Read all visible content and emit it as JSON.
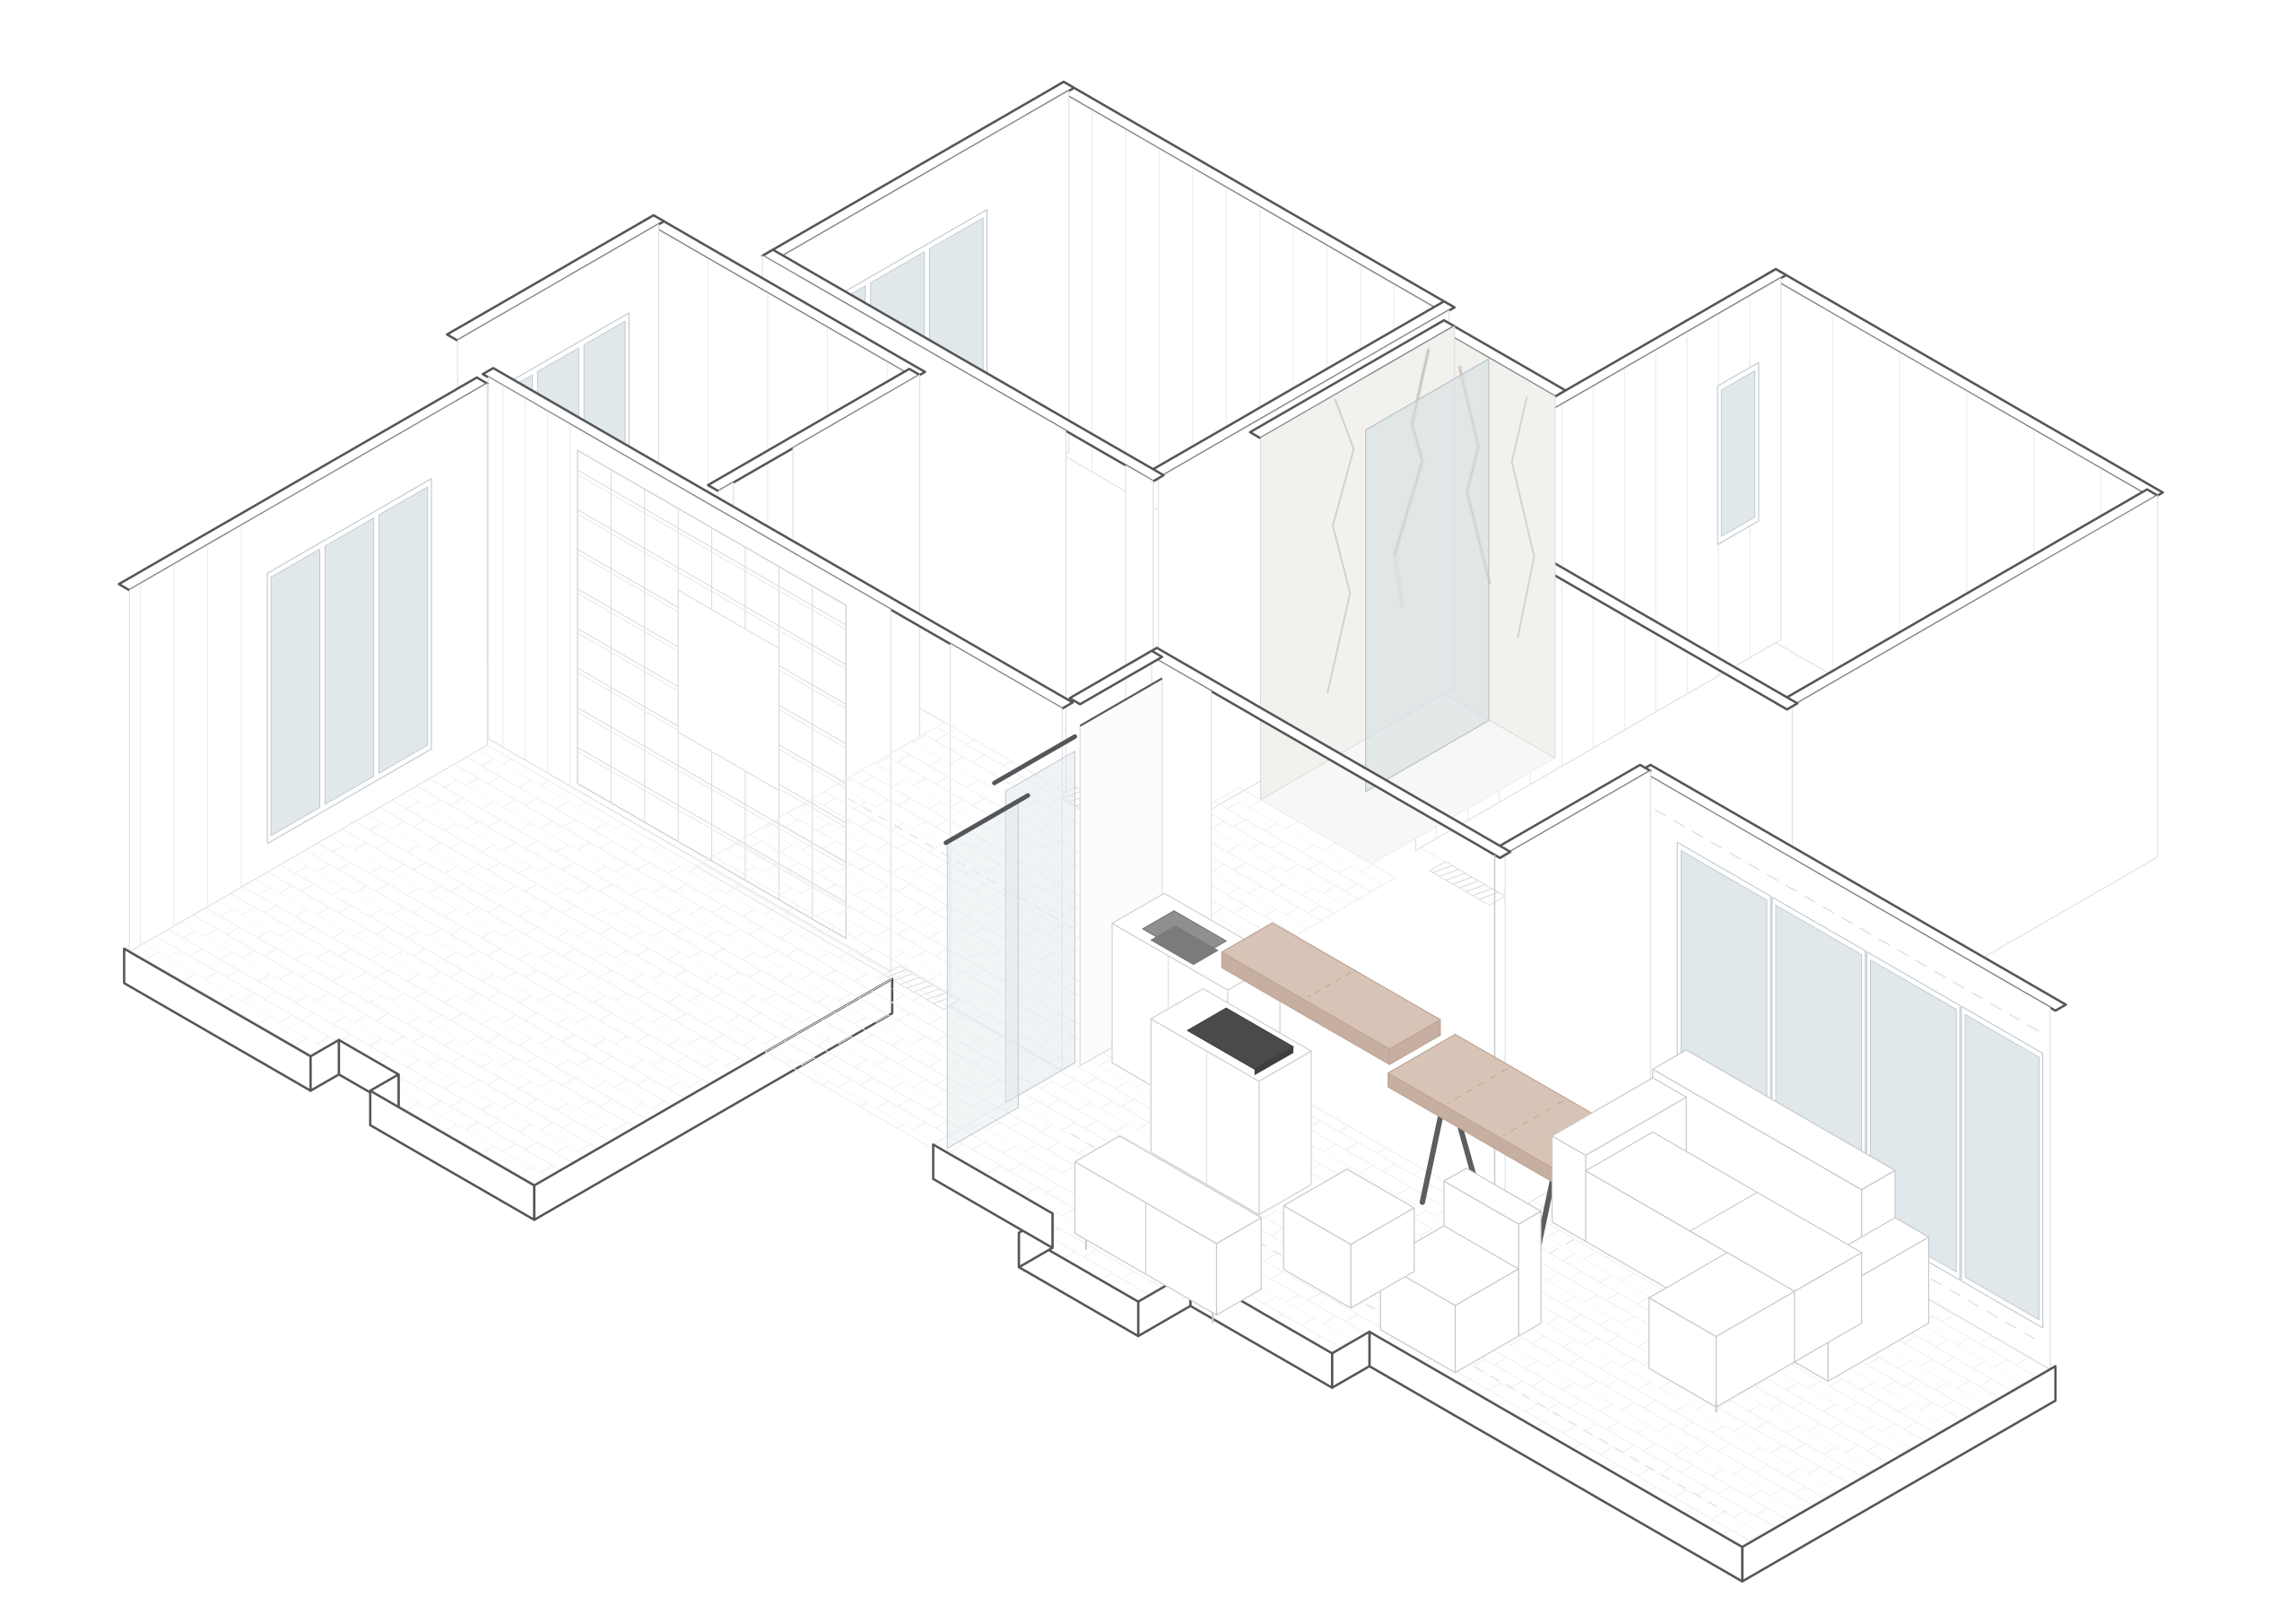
{
  "document": {
    "type": "architectural-axonometric-cutaway",
    "subject": "apartment floor plan, axonometric cutaway view",
    "background": "#ffffff"
  },
  "palette": {
    "outline": "#55565a",
    "wallFill": "#ffffff",
    "faceLine": "#dbdce1",
    "faint": "#e9eaee",
    "floorLine": "#ecedf1",
    "floorFill": "#fdfdfe",
    "glass": "#e0e8ec",
    "glassFrame": "#c3cbd0",
    "partition": "#d6dee2",
    "marbleBase": "#f2f1ed",
    "marbleVein": "#b9b6b0",
    "marbleVeinSoft": "#dbd8d2",
    "wood": "#d8c4b6",
    "woodSide": "#c6afa0",
    "woodDark": "#bfa696",
    "darkAppliance": "#4a4a4c",
    "sinkBasin": "#8e8f91",
    "sinkDeep": "#7a7b7d",
    "metal": "#5b5e61",
    "sofaLine": "#c7c8cd",
    "dash": "#dfe0e5"
  },
  "mural": {
    "background": "#ece8df",
    "colors": {
      "pink": "#efa3b7",
      "rose": "#d796ab",
      "mauve": "#b17e93",
      "teal": "#8bd0d7",
      "tealLight": "#b2dfe3",
      "green": "#a8cc9b",
      "sage": "#c6d8b6",
      "yellow": "#f2d489",
      "beige": "#e7dab6",
      "gray": "#b7b2ac",
      "dark": "#6b6762",
      "charcoal": "#54514d",
      "cream": "#f6f3ec"
    },
    "shapes": [
      "gray-coral-leaf",
      "pink-hand",
      "teal-blob",
      "dark-triangle",
      "teal-umbrella",
      "rain-dashes",
      "green-square",
      "yellow-sprig",
      "hatched-square",
      "pink-stripe",
      "green-umbrella",
      "beige-umbrella",
      "pink-arch",
      "mauve-silhouette",
      "dark-speckled-blob",
      "teal-circle",
      "dashed-arc"
    ]
  },
  "rooms": [
    {
      "name": "bedroom-top",
      "features": [
        "window-3-pane",
        "panelled-wall",
        "door-threshold"
      ]
    },
    {
      "name": "bedroom-left",
      "features": [
        "window-3-pane",
        "door-threshold"
      ]
    },
    {
      "name": "study-room-left",
      "features": [
        "window-3-pane",
        "bookshelf-wall",
        "herringbone-floor"
      ]
    },
    {
      "name": "bathroom",
      "features": [
        "marble-walls",
        "glass-partition"
      ]
    },
    {
      "name": "dressing-room-right",
      "features": [
        "panelled-wardrobe-wall",
        "small-window"
      ]
    },
    {
      "name": "hallway",
      "features": [
        "door-thresholds",
        "herringbone-floor"
      ]
    },
    {
      "name": "living-kitchen",
      "features": [
        "mural-wall",
        "window-4-pane",
        "kitchen-counter",
        "island-cooktop",
        "bar-top",
        "dining-table",
        "sofa",
        "tv-bench",
        "sliding-glass-door",
        "herringbone-floor"
      ]
    }
  ],
  "furniture": [
    "kitchen-counter-with-sink",
    "bar-counter-top",
    "island-with-cooktop",
    "dining-table",
    "sofa-sectional",
    "ottoman",
    "tv-bench",
    "sliding-glass-door",
    "bookshelf"
  ]
}
